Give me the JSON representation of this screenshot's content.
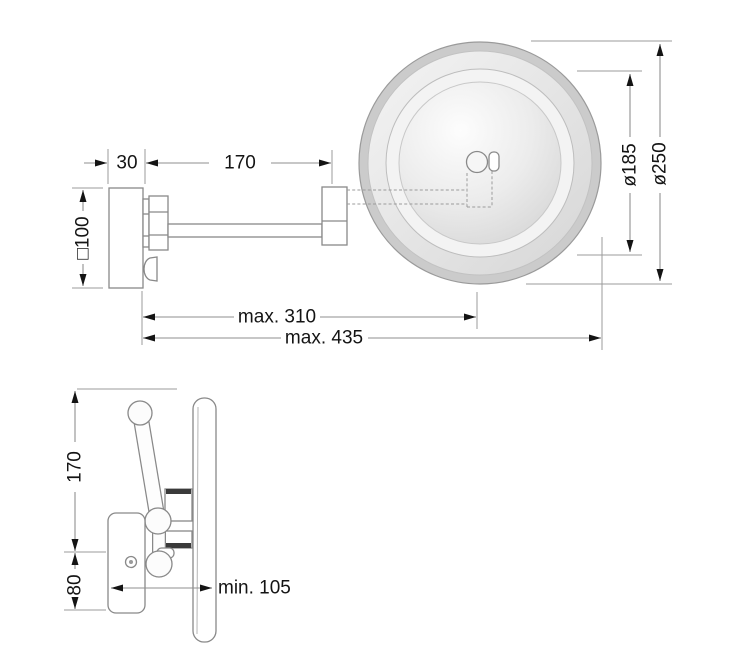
{
  "front_view": {
    "dimensions": {
      "plate_depth": "30",
      "arm_length": "170",
      "plate_square": "□100",
      "inner_diameter": "ø185",
      "outer_diameter": "ø250",
      "max_reach": "max. 310",
      "max_total_reach": "max. 435"
    }
  },
  "side_view": {
    "dimensions": {
      "upper_height": "170",
      "lower_height": "80",
      "min_projection": "min. 105"
    }
  },
  "colors": {
    "background": "#ffffff",
    "object_line": "#898989",
    "dimension_line": "#8f8f8f",
    "dimension_text": "#141414",
    "arrow": "#141414",
    "mirror_rim": "#cbcbcb",
    "mirror_highlight": "#fdfdfd",
    "mirror_shadow": "#d7d7d7"
  }
}
